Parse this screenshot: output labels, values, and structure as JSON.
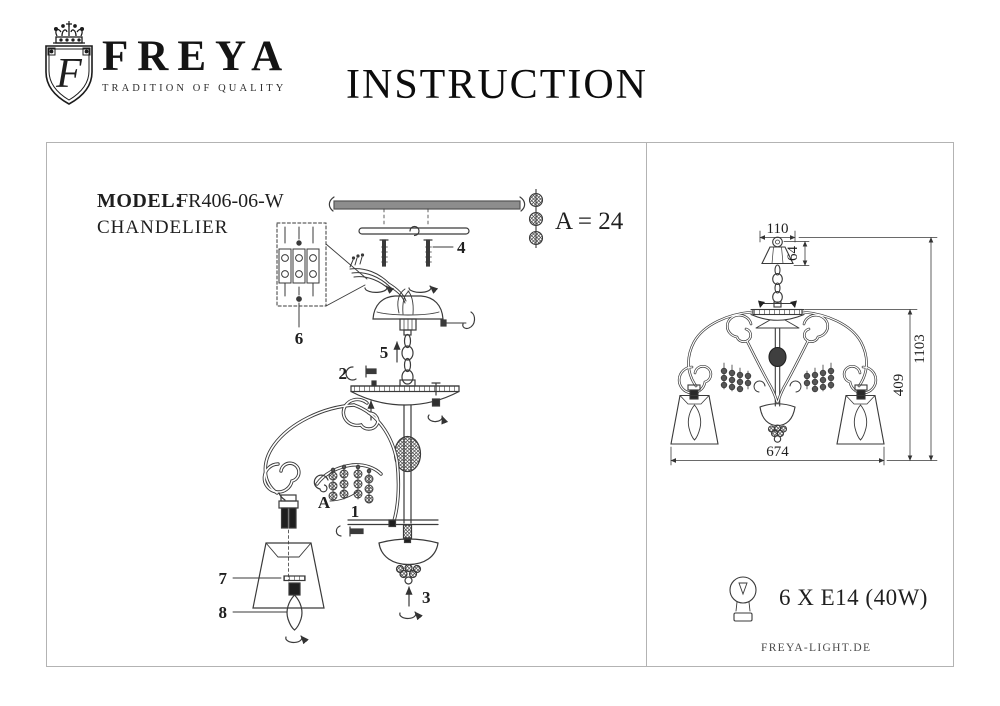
{
  "header": {
    "brand": "FREYA",
    "tagline": "TRADITION OF QUALITY",
    "title": "INSTRUCTION",
    "logo_monogram": "F"
  },
  "left_panel": {
    "model_label": "MODEL:",
    "model_value": "FR406-06-W",
    "product_type": "CHANDELIER",
    "bead_note": "A = 24",
    "part_labels": {
      "mounting_screws": "4",
      "terminal_block": "6",
      "chain": "5",
      "plate_screw": "2",
      "bead_strings": "A",
      "arm_bolt": "1",
      "shade_ring": "7",
      "bulb": "8",
      "bottom_finial": "3"
    }
  },
  "right_panel": {
    "dimensions": {
      "canopy_width": "110",
      "canopy_height": "64",
      "total_height": "1103",
      "body_height": "409",
      "overall_width": "674"
    },
    "bulb_spec": "6 X E14 (40W)",
    "website": "FREYA-LIGHT.DE"
  },
  "colors": {
    "ink": "#1f1f1f",
    "line": "#3a3a3a",
    "frame": "#b3b3b3"
  }
}
